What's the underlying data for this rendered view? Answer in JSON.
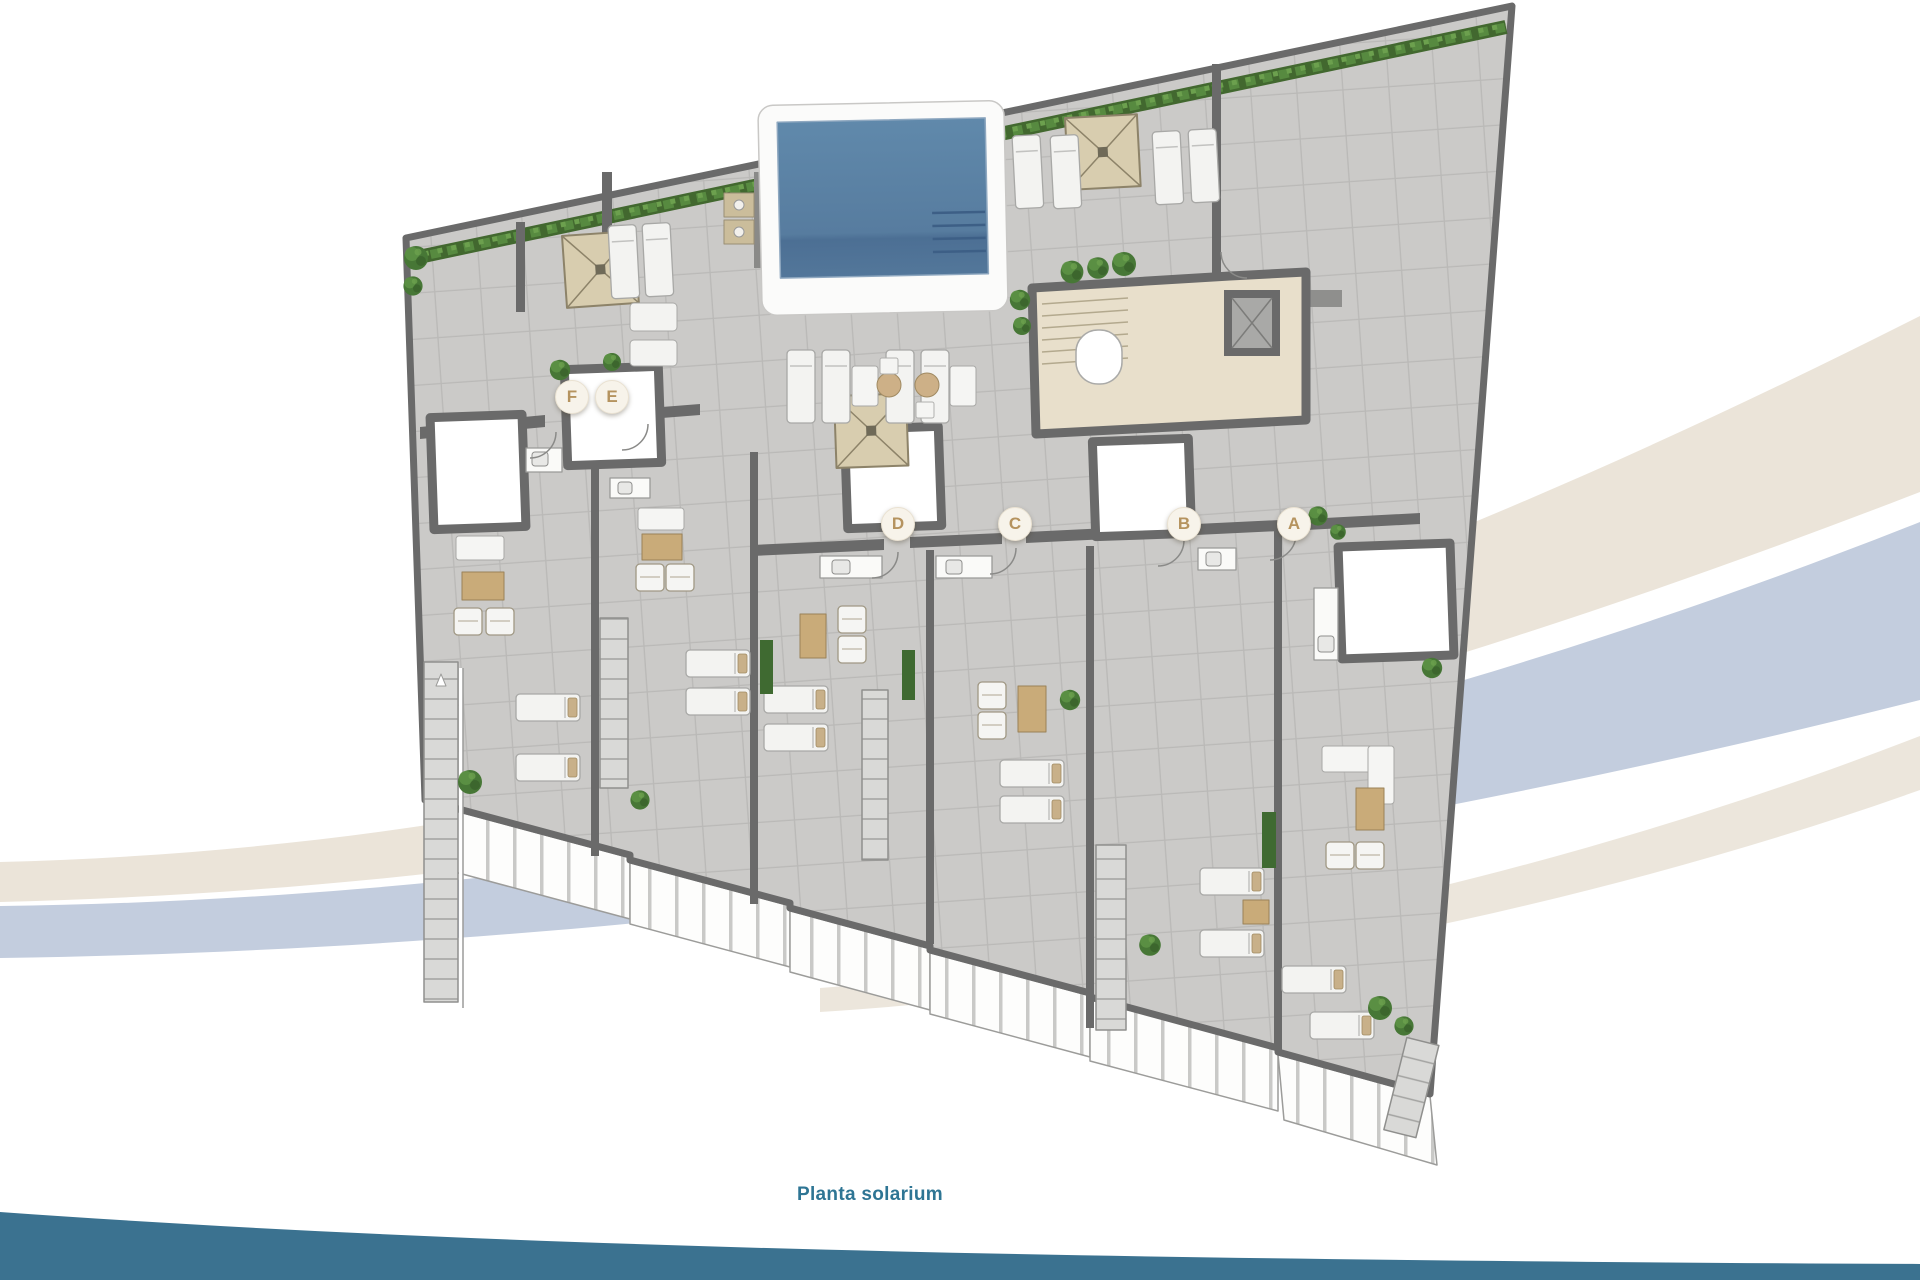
{
  "caption": {
    "label": "Planta solarium"
  },
  "plan": {
    "markers": [
      {
        "id": "F",
        "label": "F"
      },
      {
        "id": "E",
        "label": "E"
      },
      {
        "id": "D",
        "label": "D"
      },
      {
        "id": "C",
        "label": "C"
      },
      {
        "id": "B",
        "label": "B"
      },
      {
        "id": "A",
        "label": "A"
      }
    ]
  },
  "colors": {
    "caption_text": "#2e7594",
    "bottom_band": "#3b7290",
    "marker_letter": "#b5935f",
    "marker_fill": "#f7f3ea",
    "pool_water": "#5d83a6",
    "pergola": "#d8cdaf",
    "hedge_green": "#42682f",
    "swoosh_beige": "#ebe4d9",
    "swoosh_blue": "#c3cdde",
    "wall_gray": "#6a6a6a"
  }
}
